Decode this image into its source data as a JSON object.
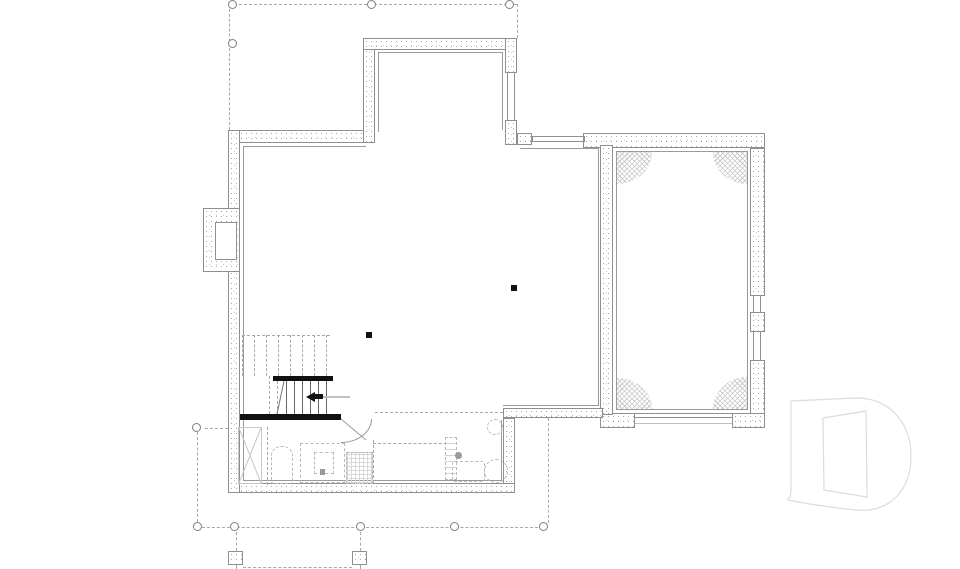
{
  "document": {
    "kind": "basement foundation floor plan drawing",
    "visible_text": [
      "D"
    ]
  },
  "watermark": {
    "letter": "D"
  },
  "palette": {
    "background": "#ffffff",
    "wall_line": "#8f8f8f",
    "inner_line": "#9a9a9a",
    "stipple_dot": "#b0b0b0",
    "dashed_line": "#a8a8a8",
    "hatch_line": "#c7c7c7",
    "solid_black": "#111111",
    "fixture_dash": "#b8b8b8",
    "arrow_tail": "#c0c0c0",
    "logo_outline": "#dcdcdc"
  },
  "symbols": {
    "deck_posts": 10,
    "deck_piers": 2,
    "structural_columns": 2,
    "stair_treads": 6,
    "garage_corner_hatches": 4,
    "window_openings": 4,
    "swing_doors": 1,
    "garage_door_openings": 1,
    "chimney_foundations": 1
  }
}
